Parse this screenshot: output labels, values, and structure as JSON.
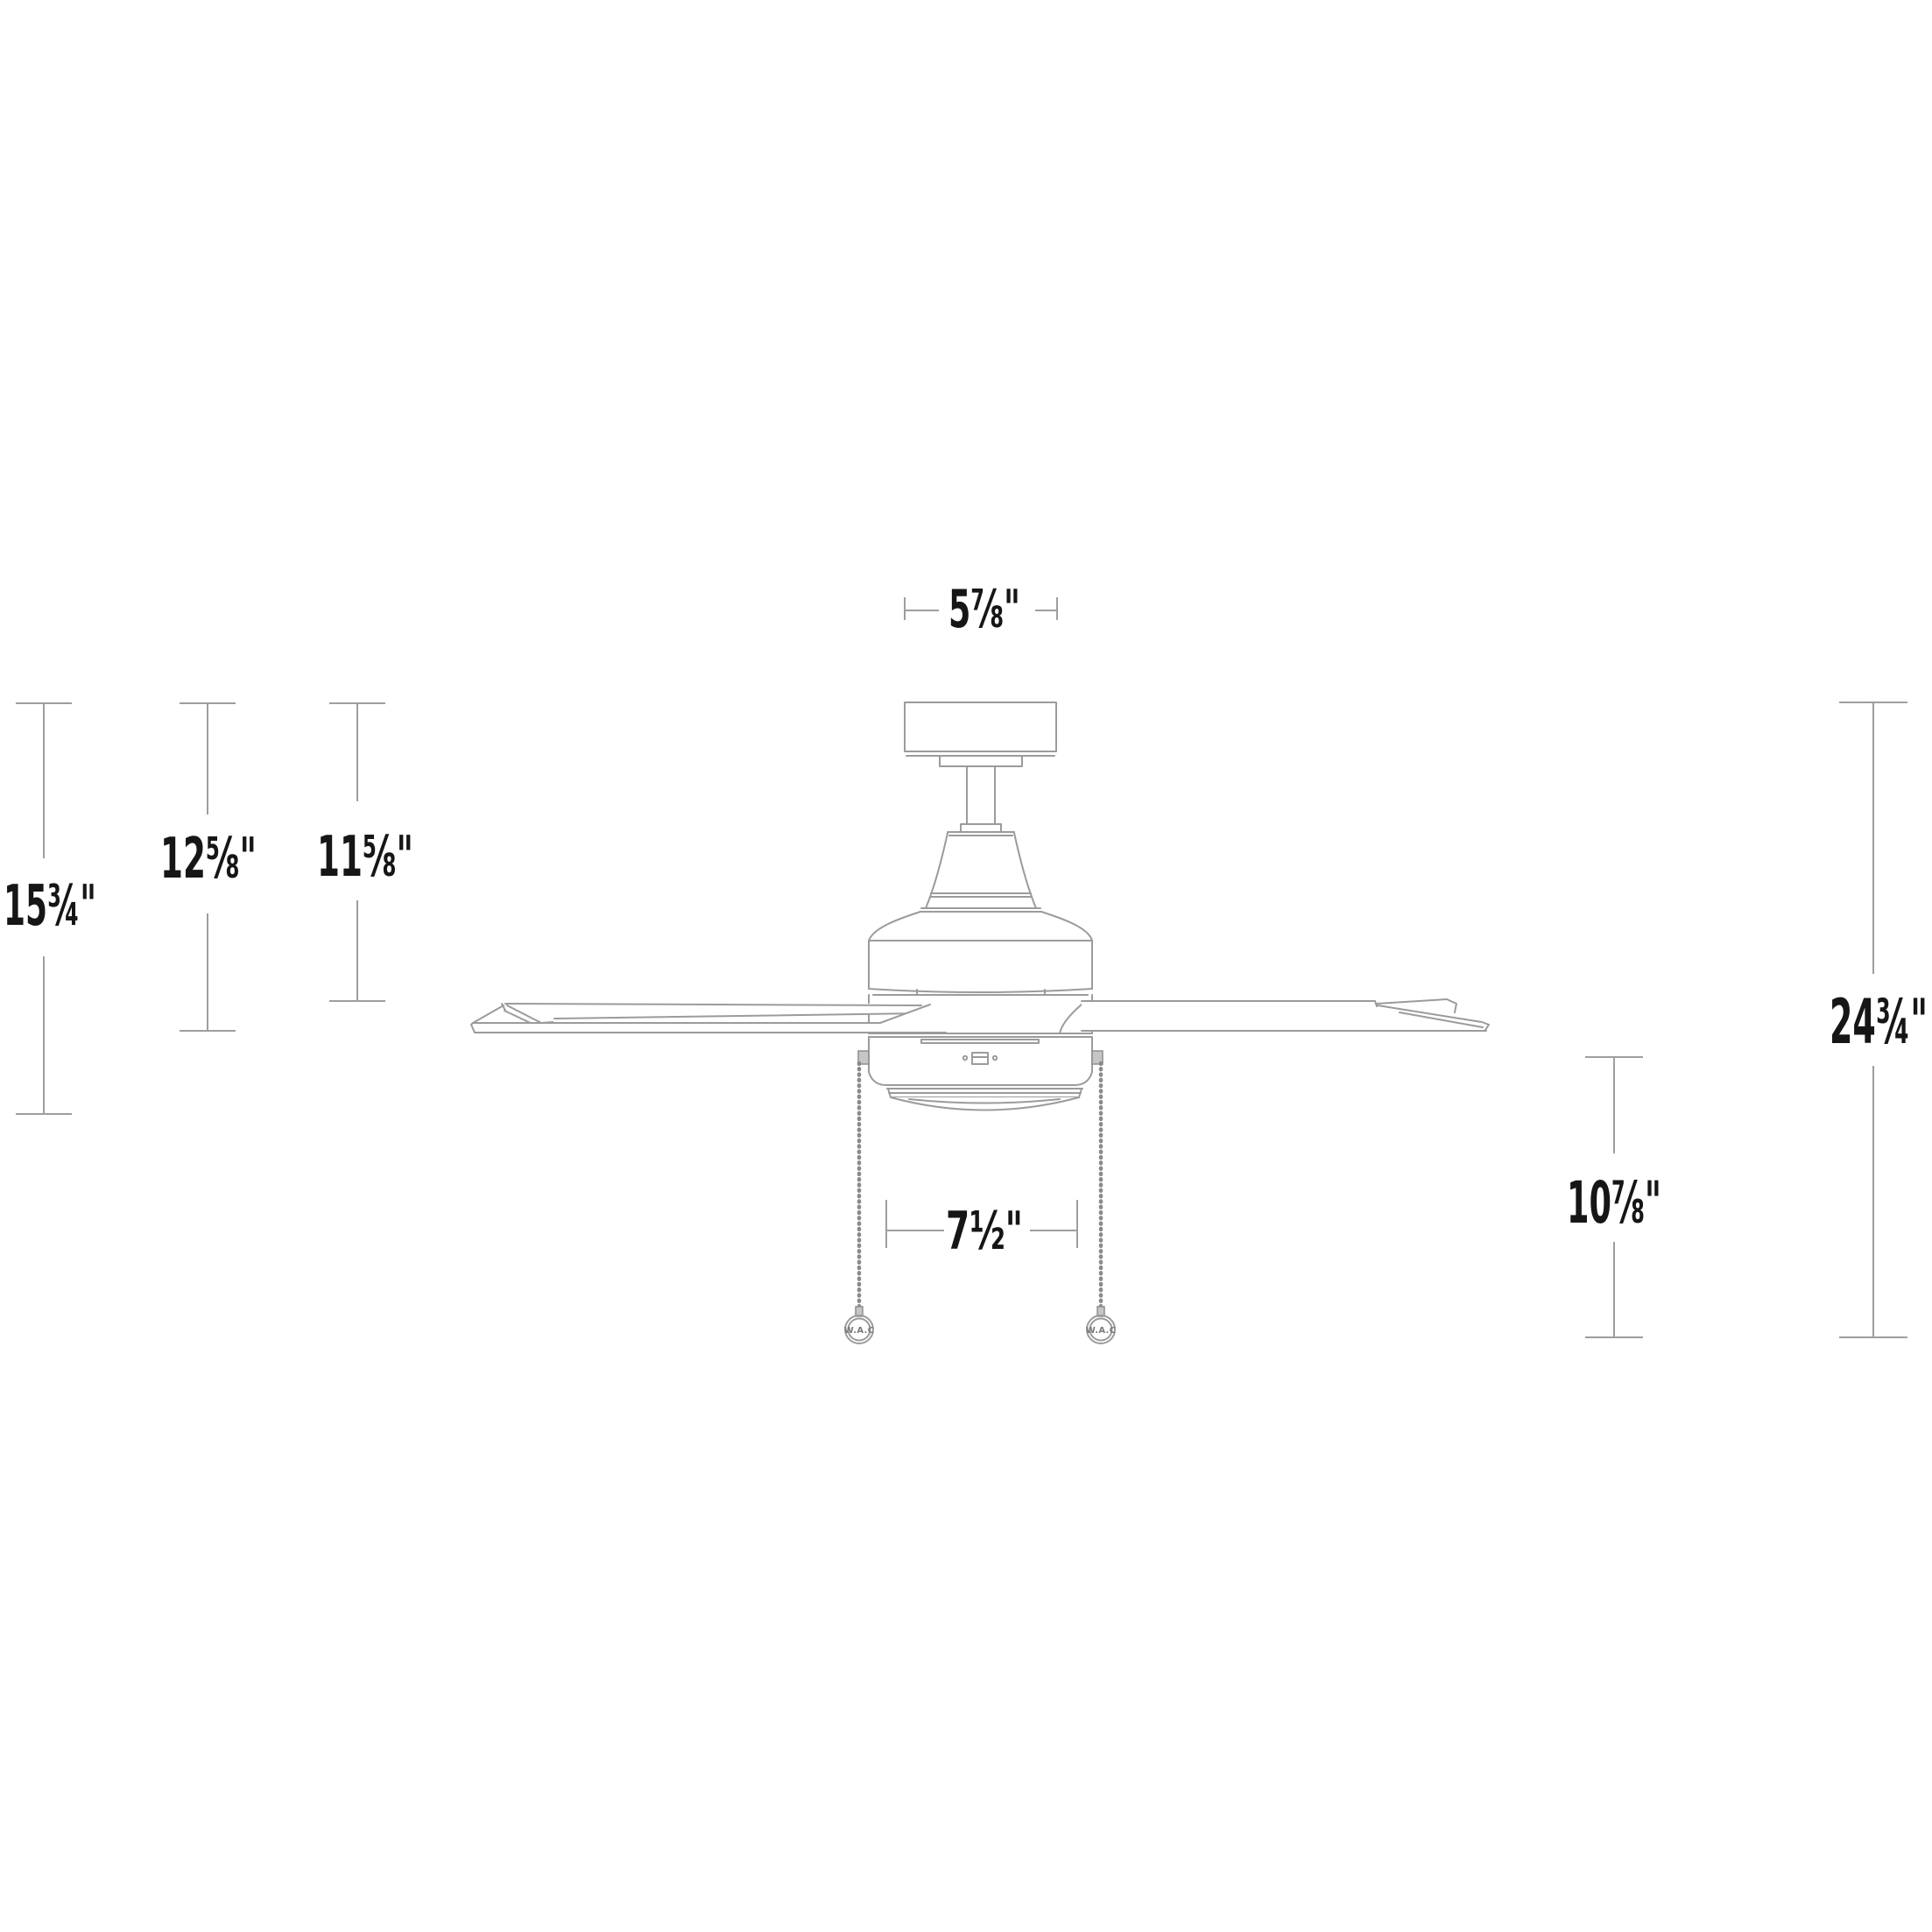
{
  "diagram": {
    "type": "ceiling-fan-dimension-drawing",
    "labels": {
      "dim_top_width": "5⅞\"",
      "dim_left_outer": "15¾\"",
      "dim_left_middle": "12⅝\"",
      "dim_left_inner": "11⅝\"",
      "dim_right_overall": "24¾\"",
      "dim_right_lower": "10⅞\"",
      "dim_bottom_width": "7½\""
    },
    "pull_chain_tags": {
      "left": "W.A.C",
      "right": "W.A.C"
    },
    "colors": {
      "line_art": "#9b9b9b",
      "dimension_line": "#9e9e9e",
      "label_text": "#161616",
      "background": "#ffffff"
    }
  }
}
